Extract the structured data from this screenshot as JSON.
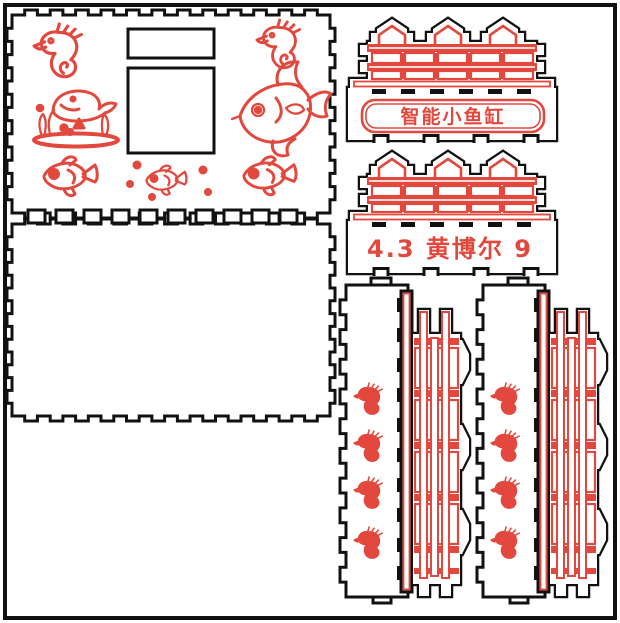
{
  "design": {
    "background": "#ffffff",
    "cut_color": "#111111",
    "engrave_color": "#e2483d",
    "banner_title": "智能小鱼缸",
    "signature": "4.3 黄博尔 9",
    "motifs": {
      "seahorse": "seahorse-icon",
      "whale_scene": "whale-with-seaweed-icon",
      "angelfish": "angelfish-icon",
      "fish": "fish-icon",
      "bubbles": "bubble-dots-icon"
    }
  }
}
